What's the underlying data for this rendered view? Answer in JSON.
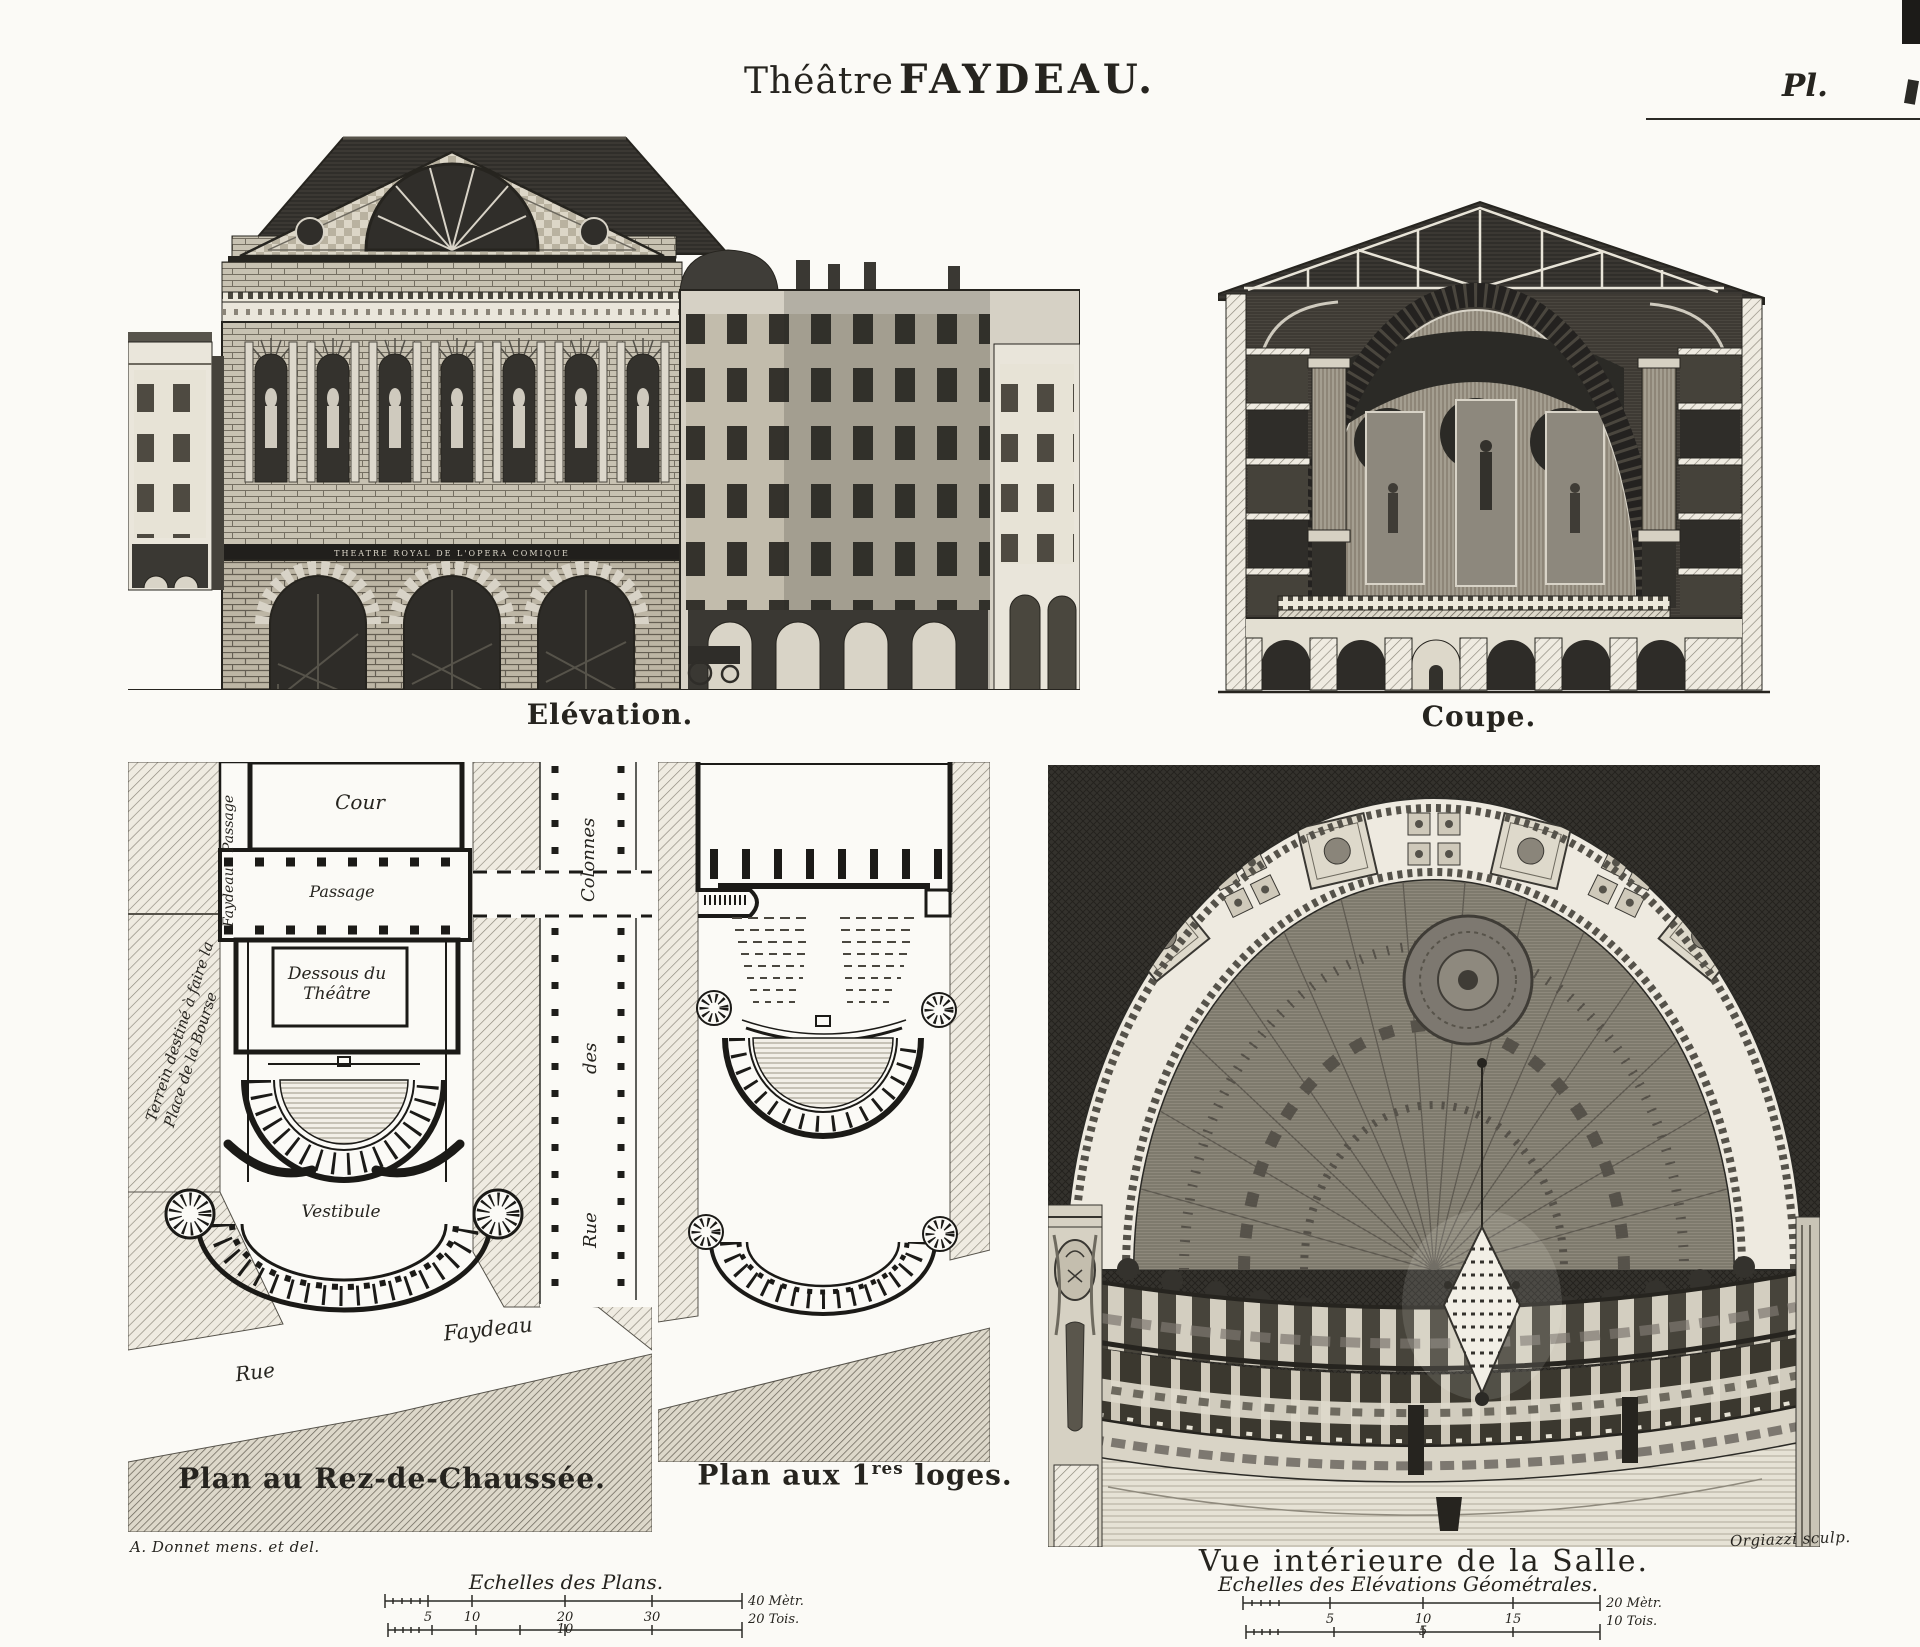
{
  "header": {
    "title_regular": "Théâtre",
    "title_bold": "FAYDEAU.",
    "plate": "Pl."
  },
  "top_figures": {
    "elevation_caption": "Elévation.",
    "coupe_caption": "Coupe.",
    "frieze_inscription": "THEATRE ROYAL DE L'OPERA COMIQUE"
  },
  "ground_plan": {
    "caption": "Plan au Rez-de-Chaussée.",
    "cour": "Cour",
    "passage": "Passage",
    "passage_vert": "Passage",
    "faydeau_vert": "Faydeau",
    "dessous_1": "Dessous du",
    "dessous_2": "Théâtre",
    "terrain_1": "Terrein destiné à faire la",
    "terrain_2": "Place de la Bourse",
    "vestibule": "Vestibule",
    "rue_diag": "Rue",
    "faydeau_diag": "Faydeau"
  },
  "street": {
    "rue": "Rue",
    "des": "des",
    "colonnes": "Colonnes"
  },
  "loges_plan": {
    "caption_prefix": "Plan aux 1",
    "caption_sup": "res",
    "caption_suffix": " loges."
  },
  "interior": {
    "caption": "Vue intérieure de la Salle."
  },
  "scales": {
    "plans": {
      "title": "Echelles des Plans.",
      "t5": "5",
      "t10": "10",
      "t20": "20",
      "t30": "30",
      "metric_end": "40 Mètr.",
      "toise_mid": "10",
      "toise_end": "20 Tois."
    },
    "elevations": {
      "title": "Echelles des Elévations Géométrales.",
      "t5": "5",
      "t10": "10",
      "t15": "15",
      "metric_end": "20 Mètr.",
      "toise_mid": "5",
      "toise_end": "10 Tois."
    }
  },
  "credits": {
    "delineator": "A. Donnet mens. et del.",
    "engraver": "Orgiazzi sculp."
  }
}
